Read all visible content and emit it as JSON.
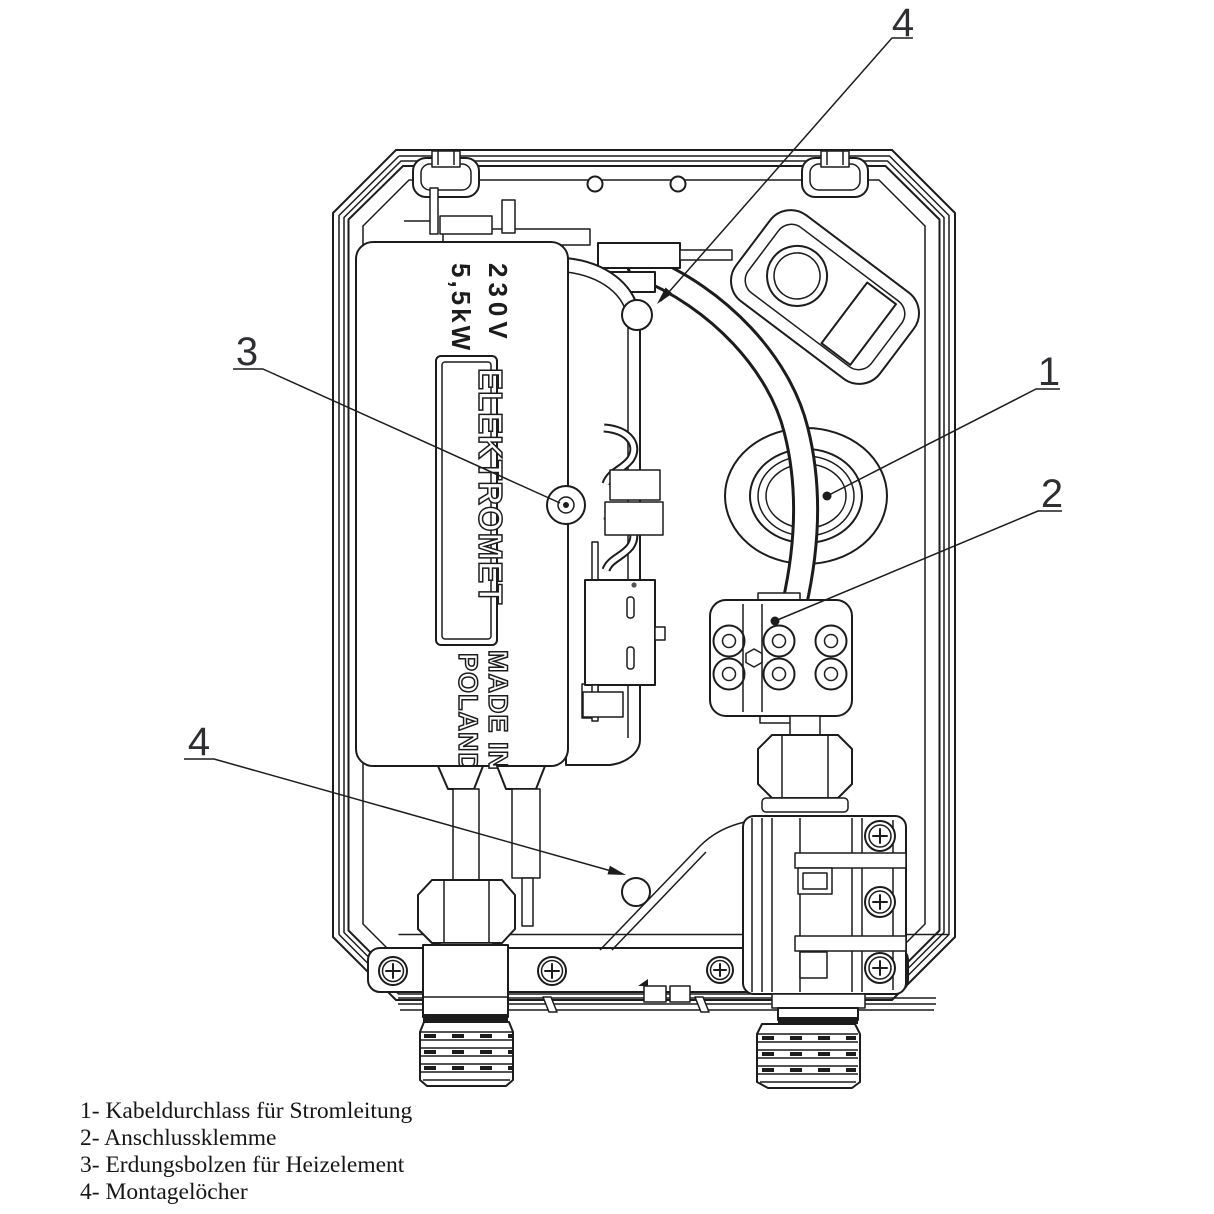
{
  "device": {
    "voltage": "230V",
    "power": "5,5kW",
    "brand": "ELEKTROMET",
    "made_in_line1": "MADE IN",
    "made_in_line2": "POLAND"
  },
  "callouts": {
    "top": "4",
    "left": "3",
    "right_upper": "1",
    "right_lower": "2",
    "bottom_left": "4"
  },
  "legend": {
    "items": [
      "1- Kabeldurchlass für Stromleitung",
      "2- Anschlussklemme",
      "3- Erdungsbolzen für Heizelement",
      "4- Montagelöcher"
    ]
  },
  "colors": {
    "line": "#1c1c1c",
    "background": "#ffffff",
    "callout_text": "#2f2f33"
  }
}
